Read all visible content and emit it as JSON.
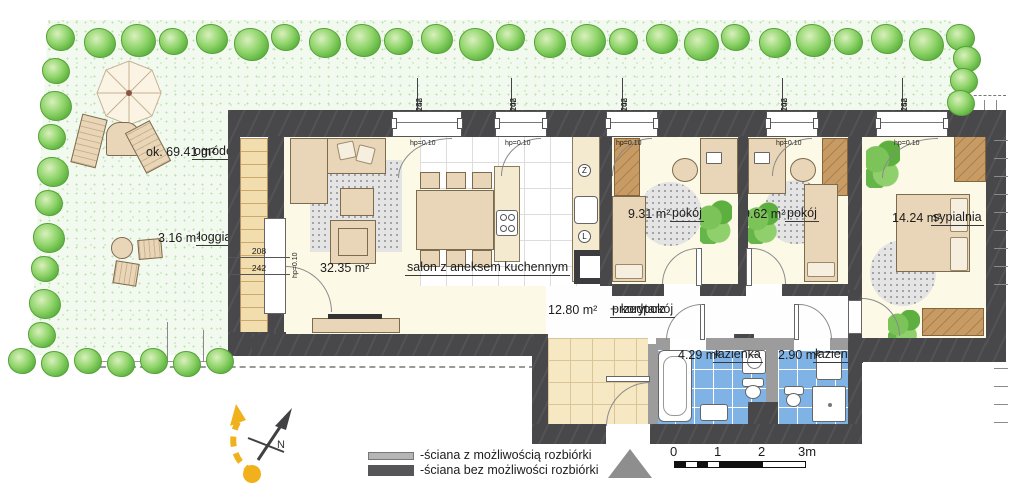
{
  "garden": {
    "name": "ogródek",
    "area": "ok. 69.41 m²"
  },
  "loggia": {
    "name": "loggia",
    "area": "3.16 m²"
  },
  "salon": {
    "name": "salon z aneksem kuchennym",
    "area": "32.35 m²"
  },
  "pokoj1": {
    "name": "pokój",
    "area": "9.31 m²"
  },
  "pokoj2": {
    "name": "pokój",
    "area": "9.62 m²"
  },
  "sypialnia": {
    "name": "sypialnia",
    "area": "14.24 m²"
  },
  "przedpokoj": {
    "name": "przedpokój",
    "name_rest": " + korytarz",
    "area": "12.80 m²"
  },
  "lazienka1": {
    "name": "łazienka",
    "area": "4.29 m²"
  },
  "lazienka2": {
    "name": "łazienka",
    "area": "2.90 m²"
  },
  "windows": {
    "hp_label": "hp=0.10",
    "dims": [
      {
        "width": "158",
        "height": "242"
      },
      {
        "width": "108",
        "height": "242"
      },
      {
        "width": "108",
        "height": "242"
      },
      {
        "width": "108",
        "height": "242"
      },
      {
        "width": "158",
        "height": "242"
      }
    ]
  },
  "balcony_door": {
    "width": "208",
    "height": "242",
    "hp_label": "hp=0.10"
  },
  "kitchen": {
    "dishwasher_symbol": "Z",
    "fridge_symbol": "L"
  },
  "legend": {
    "wall_demolishable": "-ściana z możliwością rozbiórki",
    "wall_structural": "-ściana bez możliwości rozbiórki"
  },
  "scale_bar": {
    "labels": [
      "0",
      "1",
      "2",
      "3m"
    ]
  },
  "compass": {
    "north_label": "N"
  },
  "colors": {
    "wall_dark": "#48484b",
    "wall_light": "#9c9c9c",
    "floor_cream": "#fcf9e7",
    "hall_tile": "#f6e8c3",
    "bath_tile": "#7fb2e5",
    "garden_green": "#f2f9ee",
    "bush_green": "#7cc95c",
    "accent_yellow": "#f1b11c"
  }
}
